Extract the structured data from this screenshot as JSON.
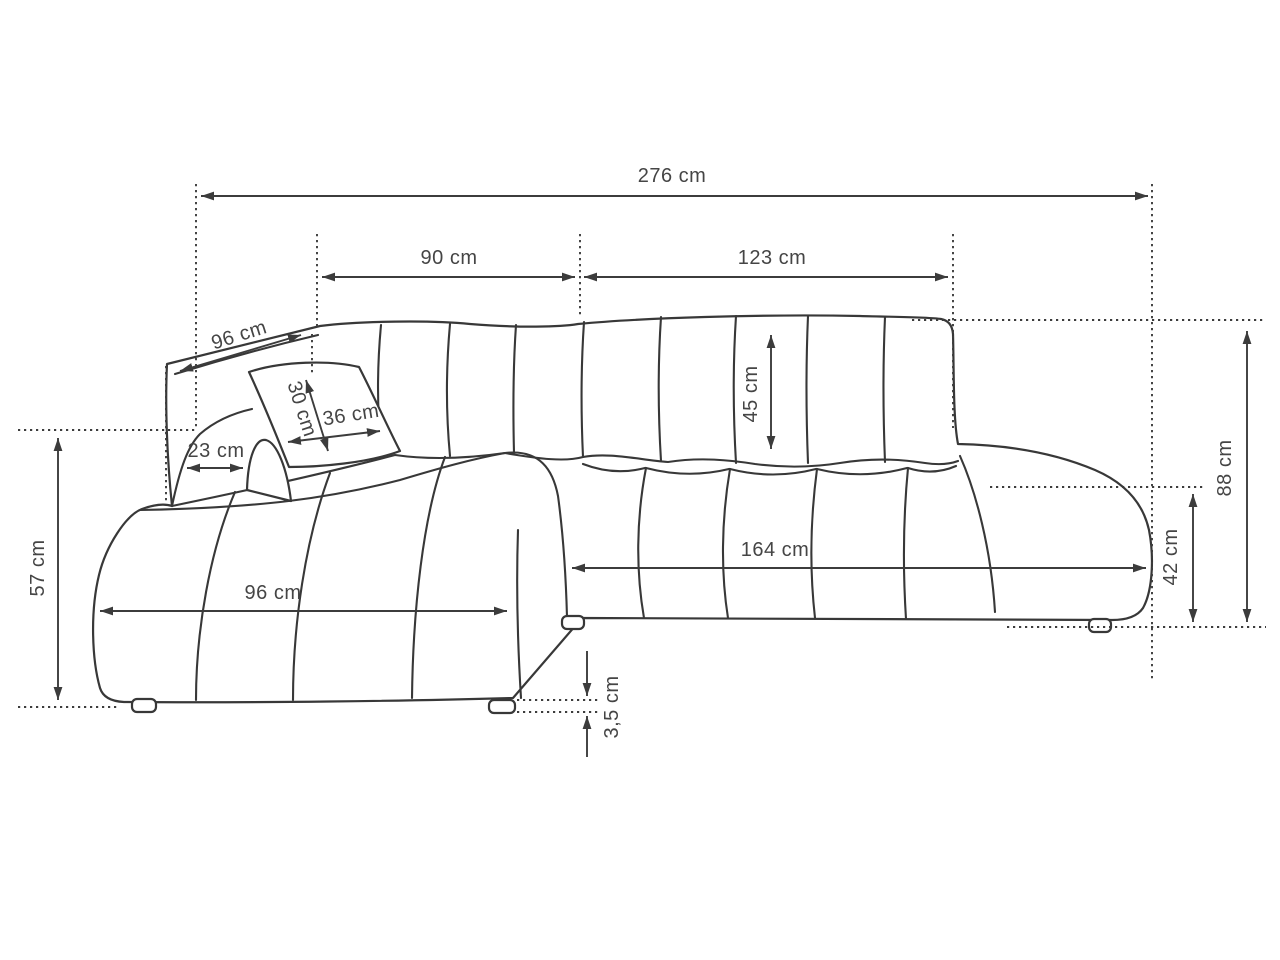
{
  "diagram": {
    "subject": "corner-sofa-dimension-drawing",
    "unit": "cm",
    "background_color": "#ffffff",
    "line_color": "#383838",
    "text_color": "#454545",
    "dims": {
      "overall_width": "276 cm",
      "back_section_left_width": "90 cm",
      "back_section_right_width": "123 cm",
      "chaise_back_depth": "96 cm",
      "pillow_height": "30 cm",
      "pillow_width": "36 cm",
      "back_rail_width": "23 cm",
      "backrest_cushion_height": "45 cm",
      "overall_height": "88 cm",
      "armrest_height": "42 cm",
      "seat_front_width": "164 cm",
      "chaise_length": "96 cm",
      "chaise_side_height": "57 cm",
      "leg_height": "3,5 cm"
    }
  }
}
